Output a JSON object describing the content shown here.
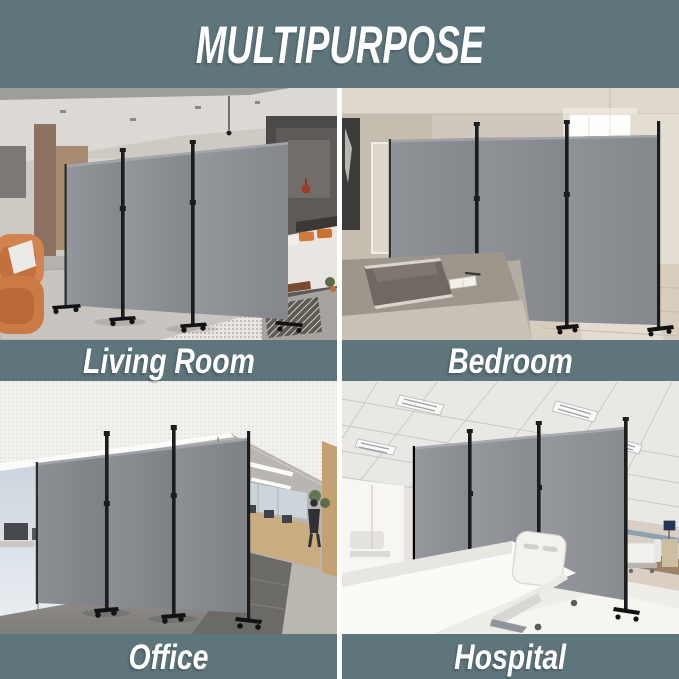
{
  "title": "MULTIPURPOSE",
  "sections": [
    {
      "id": "living-room",
      "label": "Living Room"
    },
    {
      "id": "bedroom",
      "label": "Bedroom"
    },
    {
      "id": "office",
      "label": "Office"
    },
    {
      "id": "hospital",
      "label": "Hospital"
    }
  ],
  "colors": {
    "background": "#5e757c",
    "title_text": "#ffffff",
    "label_text": "#ffffff",
    "gutter": "#ffffff",
    "divider_panel": "#8b8e92",
    "divider_frame": "#1e1f21"
  }
}
